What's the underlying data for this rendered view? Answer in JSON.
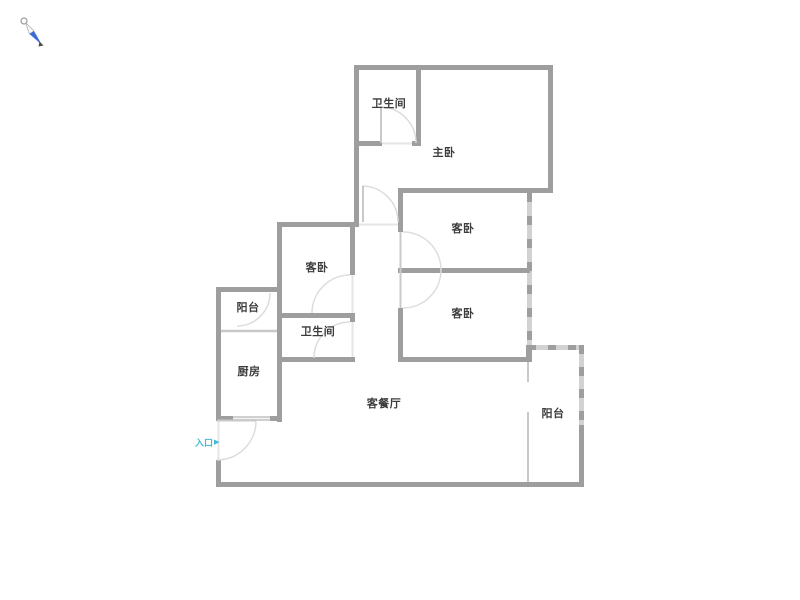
{
  "title": "apartment-floor-plan",
  "colors": {
    "wall": "#9e9e9e",
    "window": "#d2d2d2",
    "window_light": "#c8c8c8",
    "door_arc": "#dcdcdc",
    "threshold": "#e5e5e5",
    "entrance_text": "#3fb9d5",
    "label_text": "#3c3c3c",
    "compass_blue": "#3d6bd6"
  },
  "compass": {
    "icon": "compass-needle-icon"
  },
  "rooms": [
    {
      "id": "bathroom-top",
      "label": "卫生间",
      "x": 389,
      "y": 103
    },
    {
      "id": "master-bedroom",
      "label": "主卧",
      "x": 444,
      "y": 152
    },
    {
      "id": "guest-bedroom-ne",
      "label": "客卧",
      "x": 463,
      "y": 228
    },
    {
      "id": "guest-bedroom-w",
      "label": "客卧",
      "x": 317,
      "y": 267
    },
    {
      "id": "guest-bedroom-se",
      "label": "客卧",
      "x": 463,
      "y": 313
    },
    {
      "id": "balcony-west",
      "label": "阳台",
      "x": 248,
      "y": 307
    },
    {
      "id": "bathroom-mid",
      "label": "卫生间",
      "x": 318,
      "y": 331
    },
    {
      "id": "kitchen",
      "label": "厨房",
      "x": 249,
      "y": 371
    },
    {
      "id": "living-dining",
      "label": "客餐厅",
      "x": 384,
      "y": 403
    },
    {
      "id": "balcony-east",
      "label": "阳台",
      "x": 553,
      "y": 413
    }
  ],
  "entrance": {
    "label": "入口",
    "arrow": "▶"
  }
}
